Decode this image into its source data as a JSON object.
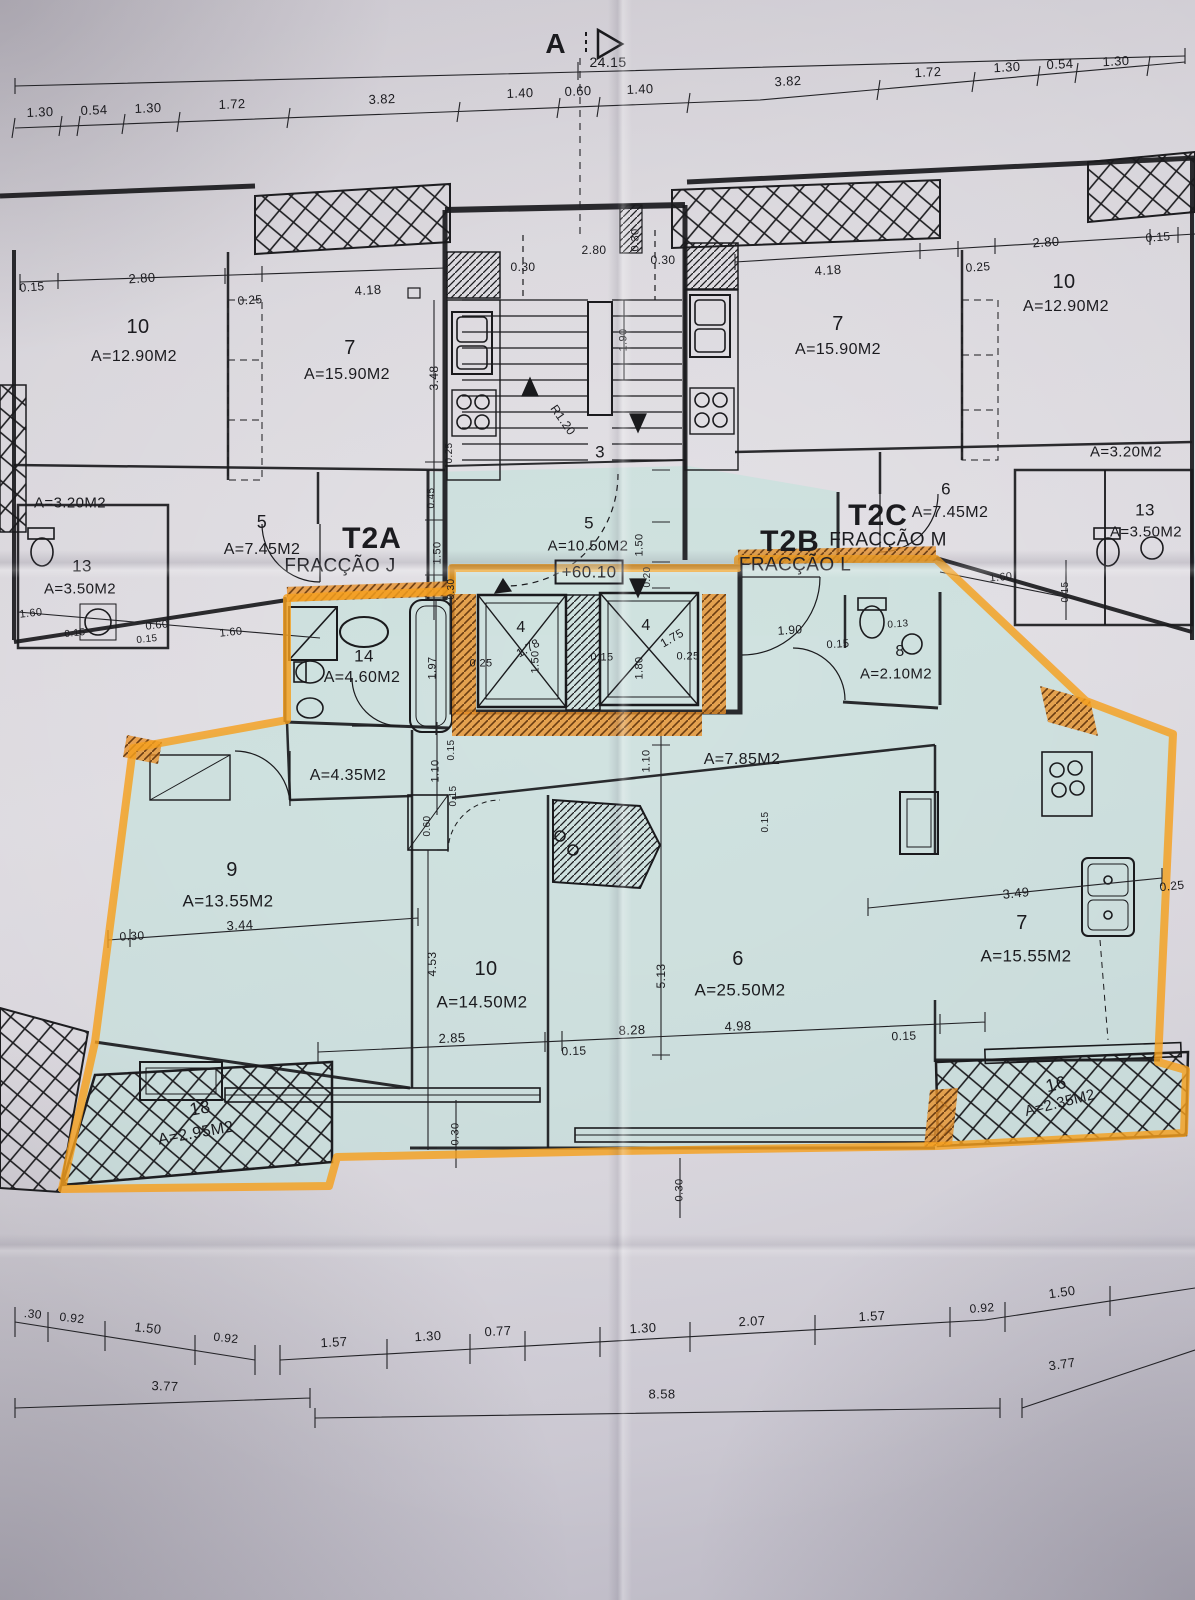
{
  "zones": {
    "top_marks": [
      {
        "t": "A",
        "x": 556,
        "y": 44,
        "s": 28,
        "b": 1,
        "n": "section-marker-letter"
      },
      {
        "t": "24.15",
        "x": 608,
        "y": 62,
        "s": 14,
        "n": "overall-width-dim"
      }
    ],
    "top_dims": [
      {
        "t": "1.30",
        "x": 40,
        "y": 112,
        "s": 13,
        "r": -2
      },
      {
        "t": "0.54",
        "x": 94,
        "y": 110,
        "s": 13,
        "r": -2
      },
      {
        "t": "1.30",
        "x": 148,
        "y": 108,
        "s": 13,
        "r": -2
      },
      {
        "t": "1.72",
        "x": 232,
        "y": 104,
        "s": 13,
        "r": -2
      },
      {
        "t": "3.82",
        "x": 382,
        "y": 99,
        "s": 13,
        "r": -2
      },
      {
        "t": "1.40",
        "x": 520,
        "y": 93,
        "s": 13,
        "r": -2
      },
      {
        "t": "0.60",
        "x": 578,
        "y": 91,
        "s": 13,
        "r": -2
      },
      {
        "t": "1.40",
        "x": 640,
        "y": 89,
        "s": 13,
        "r": -2
      },
      {
        "t": "3.82",
        "x": 788,
        "y": 81,
        "s": 13,
        "r": -3
      },
      {
        "t": "1.72",
        "x": 928,
        "y": 72,
        "s": 13,
        "r": -3
      },
      {
        "t": "1.30",
        "x": 1007,
        "y": 67,
        "s": 13,
        "r": -3
      },
      {
        "t": "0.54",
        "x": 1060,
        "y": 64,
        "s": 13,
        "r": -3
      },
      {
        "t": "1.30",
        "x": 1116,
        "y": 61,
        "s": 13,
        "r": -3
      }
    ],
    "upper_left_apartment": [
      {
        "t": "0.15",
        "x": 32,
        "y": 287,
        "s": 12,
        "r": -4
      },
      {
        "t": "2.80",
        "x": 142,
        "y": 278,
        "s": 13,
        "r": -4
      },
      {
        "t": "0.25",
        "x": 250,
        "y": 300,
        "s": 12,
        "r": -4
      },
      {
        "t": "4.18",
        "x": 368,
        "y": 290,
        "s": 13,
        "r": -4
      },
      {
        "t": "10",
        "x": 138,
        "y": 327,
        "s": 20,
        "n": "room-number"
      },
      {
        "t": "A=12.90M2",
        "x": 134,
        "y": 357,
        "s": 16,
        "n": "room-area"
      },
      {
        "t": "7",
        "x": 350,
        "y": 348,
        "s": 20,
        "n": "room-number"
      },
      {
        "t": "A=15.90M2",
        "x": 347,
        "y": 375,
        "s": 16,
        "n": "room-area"
      },
      {
        "t": "3.48",
        "x": 434,
        "y": 378,
        "s": 12,
        "r": -90
      },
      {
        "t": "A=3.20M2",
        "x": 70,
        "y": 503,
        "s": 15,
        "n": "room-area"
      },
      {
        "t": "5",
        "x": 262,
        "y": 522,
        "s": 18,
        "n": "room-number"
      },
      {
        "t": "A=7.45M2",
        "x": 262,
        "y": 550,
        "s": 16,
        "n": "room-area"
      },
      {
        "t": "13",
        "x": 82,
        "y": 566,
        "s": 17,
        "n": "room-number"
      },
      {
        "t": "A=3.50M2",
        "x": 80,
        "y": 589,
        "s": 15,
        "n": "room-area"
      },
      {
        "t": "1.60",
        "x": 31,
        "y": 614,
        "s": 11,
        "r": -6
      },
      {
        "t": "0.15",
        "x": 75,
        "y": 634,
        "s": 10,
        "r": -6
      },
      {
        "t": "0.60",
        "x": 157,
        "y": 626,
        "s": 11,
        "r": -6
      },
      {
        "t": "0.15",
        "x": 147,
        "y": 640,
        "s": 10,
        "r": -6
      },
      {
        "t": "1.60",
        "x": 231,
        "y": 633,
        "s": 11,
        "r": -6
      },
      {
        "t": "T2A",
        "x": 372,
        "y": 539,
        "s": 30,
        "b": 1,
        "n": "unit-code-t2a"
      },
      {
        "t": "FRACÇÃO J",
        "x": 340,
        "y": 566,
        "s": 19,
        "n": "fraction-name-j"
      }
    ],
    "stair_core": [
      {
        "t": "2.80",
        "x": 594,
        "y": 250,
        "s": 12
      },
      {
        "t": "0.30",
        "x": 523,
        "y": 267,
        "s": 12
      },
      {
        "t": "0.30",
        "x": 663,
        "y": 260,
        "s": 12
      },
      {
        "t": "0.30",
        "x": 636,
        "y": 240,
        "s": 11,
        "r": -90
      },
      {
        "t": "1.90",
        "x": 624,
        "y": 340,
        "s": 11,
        "r": -90
      },
      {
        "t": "R1.20",
        "x": 563,
        "y": 420,
        "s": 12,
        "r": 55
      },
      {
        "t": "3",
        "x": 600,
        "y": 452,
        "s": 17,
        "n": "room-number"
      },
      {
        "t": "0.25",
        "x": 450,
        "y": 453,
        "s": 10,
        "r": -90
      }
    ],
    "upper_right_apartment": [
      {
        "t": "4.18",
        "x": 828,
        "y": 270,
        "s": 13,
        "r": -4
      },
      {
        "t": "7",
        "x": 838,
        "y": 324,
        "s": 20,
        "n": "room-number"
      },
      {
        "t": "A=15.90M2",
        "x": 838,
        "y": 350,
        "s": 16,
        "n": "room-area"
      },
      {
        "t": "2.80",
        "x": 1046,
        "y": 242,
        "s": 13,
        "r": -4
      },
      {
        "t": "0.15",
        "x": 1158,
        "y": 237,
        "s": 12,
        "r": -4
      },
      {
        "t": "0.25",
        "x": 978,
        "y": 267,
        "s": 12,
        "r": -4
      },
      {
        "t": "10",
        "x": 1064,
        "y": 282,
        "s": 20,
        "n": "room-number"
      },
      {
        "t": "A=12.90M2",
        "x": 1066,
        "y": 307,
        "s": 16,
        "n": "room-area"
      },
      {
        "t": "A=3.20M2",
        "x": 1126,
        "y": 452,
        "s": 15,
        "n": "room-area"
      },
      {
        "t": "6",
        "x": 946,
        "y": 489,
        "s": 17,
        "n": "room-number"
      },
      {
        "t": "A=7.45M2",
        "x": 950,
        "y": 513,
        "s": 16,
        "n": "room-area"
      },
      {
        "t": "13",
        "x": 1145,
        "y": 510,
        "s": 17,
        "n": "room-number"
      },
      {
        "t": "A=3.50M2",
        "x": 1146,
        "y": 532,
        "s": 15,
        "n": "room-area"
      },
      {
        "t": "1.60",
        "x": 1001,
        "y": 578,
        "s": 11,
        "r": -5
      },
      {
        "t": "0.15",
        "x": 1066,
        "y": 592,
        "s": 10,
        "r": -90
      },
      {
        "t": "T2C",
        "x": 878,
        "y": 516,
        "s": 30,
        "b": 1,
        "n": "unit-code-t2c"
      },
      {
        "t": "FRACÇÃO M",
        "x": 888,
        "y": 540,
        "s": 19,
        "n": "fraction-name-m"
      },
      {
        "t": "T2B",
        "x": 790,
        "y": 542,
        "s": 30,
        "b": 1,
        "n": "unit-code-t2b"
      },
      {
        "t": "FRACÇÃO L",
        "x": 795,
        "y": 565,
        "s": 19,
        "n": "fraction-name-l"
      }
    ],
    "hall": [
      {
        "t": "5",
        "x": 589,
        "y": 523,
        "s": 17,
        "n": "room-number"
      },
      {
        "t": "A=10.50M2",
        "x": 588,
        "y": 546,
        "s": 15,
        "n": "room-area"
      },
      {
        "t": "+60.10",
        "x": 589,
        "y": 572,
        "s": 17,
        "box": 1,
        "n": "level-elevation"
      },
      {
        "t": "0.45",
        "x": 432,
        "y": 498,
        "s": 10,
        "r": -90
      },
      {
        "t": "1.50",
        "x": 438,
        "y": 553,
        "s": 11,
        "r": -90
      },
      {
        "t": "0.30",
        "x": 452,
        "y": 589,
        "s": 10,
        "r": -90
      },
      {
        "t": "1.50",
        "x": 640,
        "y": 545,
        "s": 11,
        "r": -90
      },
      {
        "t": "0.20",
        "x": 648,
        "y": 577,
        "s": 10,
        "r": -90
      }
    ],
    "highlighted_unit": [
      {
        "t": "14",
        "x": 364,
        "y": 656,
        "s": 17,
        "n": "room-number"
      },
      {
        "t": "A=4.60M2",
        "x": 362,
        "y": 678,
        "s": 16,
        "n": "room-area"
      },
      {
        "t": "1.97",
        "x": 433,
        "y": 668,
        "s": 11,
        "r": -90
      },
      {
        "t": "4",
        "x": 521,
        "y": 628,
        "s": 16,
        "n": "elevator-number"
      },
      {
        "t": "1.78",
        "x": 528,
        "y": 648,
        "s": 12,
        "r": -30
      },
      {
        "t": "0.25",
        "x": 481,
        "y": 664,
        "s": 11
      },
      {
        "t": "1.50",
        "x": 536,
        "y": 662,
        "s": 11,
        "r": -90
      },
      {
        "t": "4",
        "x": 646,
        "y": 626,
        "s": 16,
        "n": "elevator-number"
      },
      {
        "t": "1.75",
        "x": 672,
        "y": 638,
        "s": 12,
        "r": -30
      },
      {
        "t": "0.25",
        "x": 688,
        "y": 657,
        "s": 11
      },
      {
        "t": "0.15",
        "x": 602,
        "y": 658,
        "s": 11
      },
      {
        "t": "1.80",
        "x": 640,
        "y": 668,
        "s": 11,
        "r": -90
      },
      {
        "t": "1.90",
        "x": 790,
        "y": 630,
        "s": 12,
        "r": -4
      },
      {
        "t": "0.15",
        "x": 838,
        "y": 645,
        "s": 11,
        "r": -4
      },
      {
        "t": "0.13",
        "x": 898,
        "y": 625,
        "s": 10,
        "r": -4
      },
      {
        "t": "8",
        "x": 900,
        "y": 652,
        "s": 16,
        "n": "room-number"
      },
      {
        "t": "A=2.10M2",
        "x": 896,
        "y": 674,
        "s": 15,
        "n": "room-area"
      },
      {
        "t": "A=4.35M2",
        "x": 348,
        "y": 776,
        "s": 16,
        "n": "room-area"
      },
      {
        "t": "1.10",
        "x": 436,
        "y": 771,
        "s": 11,
        "r": -90
      },
      {
        "t": "0.15",
        "x": 452,
        "y": 750,
        "s": 10,
        "r": -90
      },
      {
        "t": "0.15",
        "x": 454,
        "y": 796,
        "s": 10,
        "r": -90
      },
      {
        "t": "0.60",
        "x": 428,
        "y": 826,
        "s": 10,
        "r": -90
      },
      {
        "t": "1.10",
        "x": 647,
        "y": 761,
        "s": 11,
        "r": -90
      },
      {
        "t": "A=7.85M2",
        "x": 742,
        "y": 760,
        "s": 16,
        "n": "room-area"
      },
      {
        "t": "0.15",
        "x": 766,
        "y": 822,
        "s": 10,
        "r": -90
      },
      {
        "t": "9",
        "x": 232,
        "y": 870,
        "s": 20,
        "n": "room-number"
      },
      {
        "t": "A=13.55M2",
        "x": 228,
        "y": 901,
        "s": 17,
        "n": "room-area"
      },
      {
        "t": "3.44",
        "x": 240,
        "y": 925,
        "s": 13,
        "r": -3
      },
      {
        "t": "0.30",
        "x": 132,
        "y": 936,
        "s": 12,
        "r": -3
      },
      {
        "t": "10",
        "x": 486,
        "y": 969,
        "s": 20,
        "n": "room-number"
      },
      {
        "t": "A=14.50M2",
        "x": 482,
        "y": 1002,
        "s": 17,
        "n": "room-area"
      },
      {
        "t": "4.53",
        "x": 432,
        "y": 964,
        "s": 12,
        "r": -90
      },
      {
        "t": "5.13",
        "x": 661,
        "y": 976,
        "s": 12,
        "r": -90
      },
      {
        "t": "6",
        "x": 738,
        "y": 959,
        "s": 20,
        "n": "room-number"
      },
      {
        "t": "A=25.50M2",
        "x": 740,
        "y": 990,
        "s": 17,
        "n": "room-area"
      },
      {
        "t": "2.85",
        "x": 452,
        "y": 1038,
        "s": 13,
        "r": -2
      },
      {
        "t": "0.15",
        "x": 574,
        "y": 1051,
        "s": 12,
        "r": -2
      },
      {
        "t": "8.28",
        "x": 632,
        "y": 1030,
        "s": 13,
        "r": -2
      },
      {
        "t": "4.98",
        "x": 738,
        "y": 1026,
        "s": 13,
        "r": -2
      },
      {
        "t": "0.15",
        "x": 904,
        "y": 1036,
        "s": 12,
        "r": -2
      },
      {
        "t": "3.49",
        "x": 1016,
        "y": 893,
        "s": 13,
        "r": -6
      },
      {
        "t": "7",
        "x": 1022,
        "y": 923,
        "s": 20,
        "n": "room-number"
      },
      {
        "t": "A=15.55M2",
        "x": 1026,
        "y": 956,
        "s": 17,
        "n": "room-area"
      },
      {
        "t": "0.25",
        "x": 1172,
        "y": 886,
        "s": 12,
        "r": -6
      },
      {
        "t": "0.30",
        "x": 456,
        "y": 1134,
        "s": 11,
        "r": -90
      },
      {
        "t": "0.30",
        "x": 680,
        "y": 1190,
        "s": 11,
        "r": -90
      },
      {
        "t": "18",
        "x": 200,
        "y": 1108,
        "s": 18,
        "r": -10,
        "n": "room-number"
      },
      {
        "t": "A=2.95M2",
        "x": 196,
        "y": 1134,
        "s": 16,
        "r": -10,
        "n": "room-area"
      },
      {
        "t": "16",
        "x": 1056,
        "y": 1084,
        "s": 18,
        "r": -14,
        "n": "room-number"
      },
      {
        "t": "A=2.35M2",
        "x": 1060,
        "y": 1103,
        "s": 15,
        "r": -14,
        "n": "room-area"
      }
    ],
    "bottom_dims": [
      {
        "t": ".30",
        "x": 33,
        "y": 1314,
        "s": 12,
        "r": 6
      },
      {
        "t": "0.92",
        "x": 72,
        "y": 1318,
        "s": 12,
        "r": 6
      },
      {
        "t": "1.50",
        "x": 148,
        "y": 1328,
        "s": 13,
        "r": 6
      },
      {
        "t": "0.92",
        "x": 226,
        "y": 1338,
        "s": 12,
        "r": 6
      },
      {
        "t": "1.57",
        "x": 334,
        "y": 1342,
        "s": 13,
        "r": -3
      },
      {
        "t": "1.30",
        "x": 428,
        "y": 1336,
        "s": 13,
        "r": -3
      },
      {
        "t": "0.77",
        "x": 498,
        "y": 1331,
        "s": 13,
        "r": -3
      },
      {
        "t": "1.30",
        "x": 643,
        "y": 1328,
        "s": 13,
        "r": -3
      },
      {
        "t": "2.07",
        "x": 752,
        "y": 1321,
        "s": 13,
        "r": -3
      },
      {
        "t": "1.57",
        "x": 872,
        "y": 1316,
        "s": 13,
        "r": -3
      },
      {
        "t": "0.92",
        "x": 982,
        "y": 1308,
        "s": 12,
        "r": -4
      },
      {
        "t": "1.50",
        "x": 1062,
        "y": 1292,
        "s": 13,
        "r": -8
      },
      {
        "t": "3.77",
        "x": 165,
        "y": 1386,
        "s": 13,
        "r": 2
      },
      {
        "t": "8.58",
        "x": 662,
        "y": 1394,
        "s": 13
      },
      {
        "t": "3.77",
        "x": 1062,
        "y": 1364,
        "s": 13,
        "r": -8
      }
    ]
  },
  "colors": {
    "highlight_teal": "#bfe2da",
    "highlighter_orange": "#f5a01f",
    "ink": "#1b1b1f",
    "paper": "#d6d3d9"
  }
}
